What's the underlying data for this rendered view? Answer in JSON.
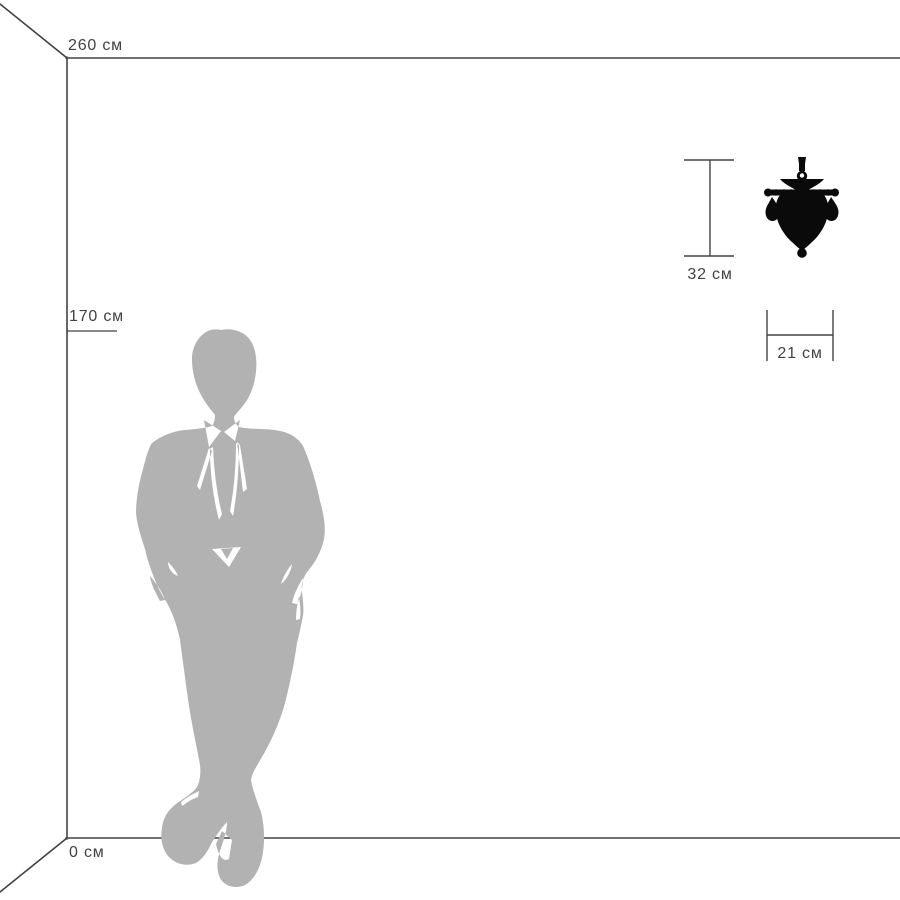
{
  "diagram": {
    "name": "product-size-reference-diagram",
    "unit": "см",
    "labels": {
      "ceiling": "260 см",
      "person": "170 см",
      "floor": "0 см",
      "product_height": "32 см",
      "product_width": "21 см"
    },
    "values": {
      "ceiling_cm": 260,
      "person_height_cm": 170,
      "floor_cm": 0,
      "product_height_cm": 32,
      "product_width_cm": 21
    },
    "figures": {
      "person": "standing-man-silhouette",
      "product": "crystal-wall-sconce-silhouette"
    },
    "colors": {
      "background": "#ffffff",
      "line": "#424242",
      "text": "#424242",
      "person-fill": "#b2b2b2",
      "product-fill": "#0a0a0a"
    }
  }
}
